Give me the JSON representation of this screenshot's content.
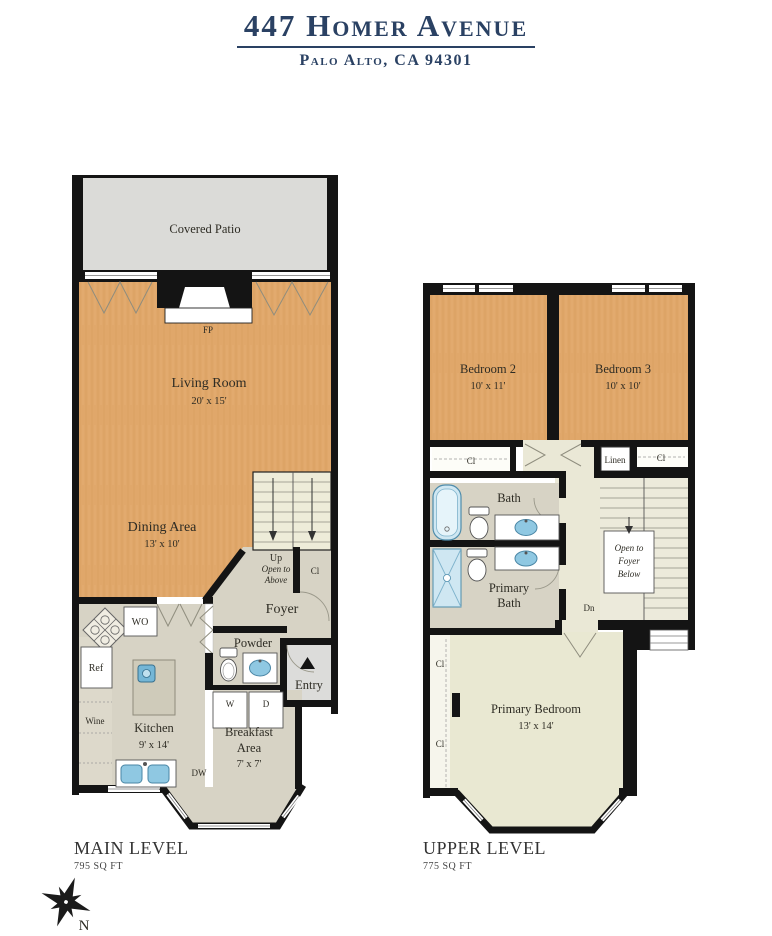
{
  "header": {
    "title": "447 Homer Avenue",
    "subtitle": "Palo Alto, CA 94301"
  },
  "main_level": {
    "title": "MAIN LEVEL",
    "area": "795 SQ FT",
    "patio": "Covered Patio",
    "fireplace": "FP",
    "living": {
      "name": "Living Room",
      "dims": "20' x 15'"
    },
    "dining": {
      "name": "Dining Area",
      "dims": "13' x 10'"
    },
    "stairs": {
      "up": "Up",
      "open1": "Open to",
      "open2": "Above"
    },
    "closet": "Cl",
    "foyer": "Foyer",
    "powder": "Powder",
    "entry": "Entry",
    "kitchen": {
      "name": "Kitchen",
      "dims": "9' x 14'"
    },
    "breakfast": {
      "line1": "Breakfast",
      "line2": "Area",
      "dims": "7' x 7'"
    },
    "appliances": {
      "wall_oven": "WO",
      "fridge": "Ref",
      "wine": "Wine",
      "dishwasher": "DW",
      "washer": "W",
      "dryer": "D"
    }
  },
  "upper_level": {
    "title": "UPPER LEVEL",
    "area": "775 SQ FT",
    "bedroom2": {
      "name": "Bedroom 2",
      "dims": "10' x 11'"
    },
    "bedroom3": {
      "name": "Bedroom 3",
      "dims": "10' x 10'"
    },
    "closet_bedroom2": "Cl",
    "linen": "Linen",
    "closet_bedroom3": "Cl",
    "bath": "Bath",
    "primary_bath": {
      "line1": "Primary",
      "line2": "Bath"
    },
    "stairs": {
      "open1": "Open to",
      "open2": "Foyer",
      "open3": "Below",
      "down": "Dn"
    },
    "primary_bedroom": {
      "name": "Primary Bedroom",
      "dims": "13' x 14'"
    },
    "closet_primary1": "Cl",
    "closet_primary2": "Cl"
  },
  "compass": {
    "north": "N"
  },
  "colors": {
    "navy": "#2a4163",
    "wood": "#e0a76a",
    "patio_gray": "#dbdbd8",
    "tile": "#d7d3c5",
    "cream": "#eae8d6",
    "fixture_blue": "#8fc8e2",
    "wall": "#141414"
  }
}
